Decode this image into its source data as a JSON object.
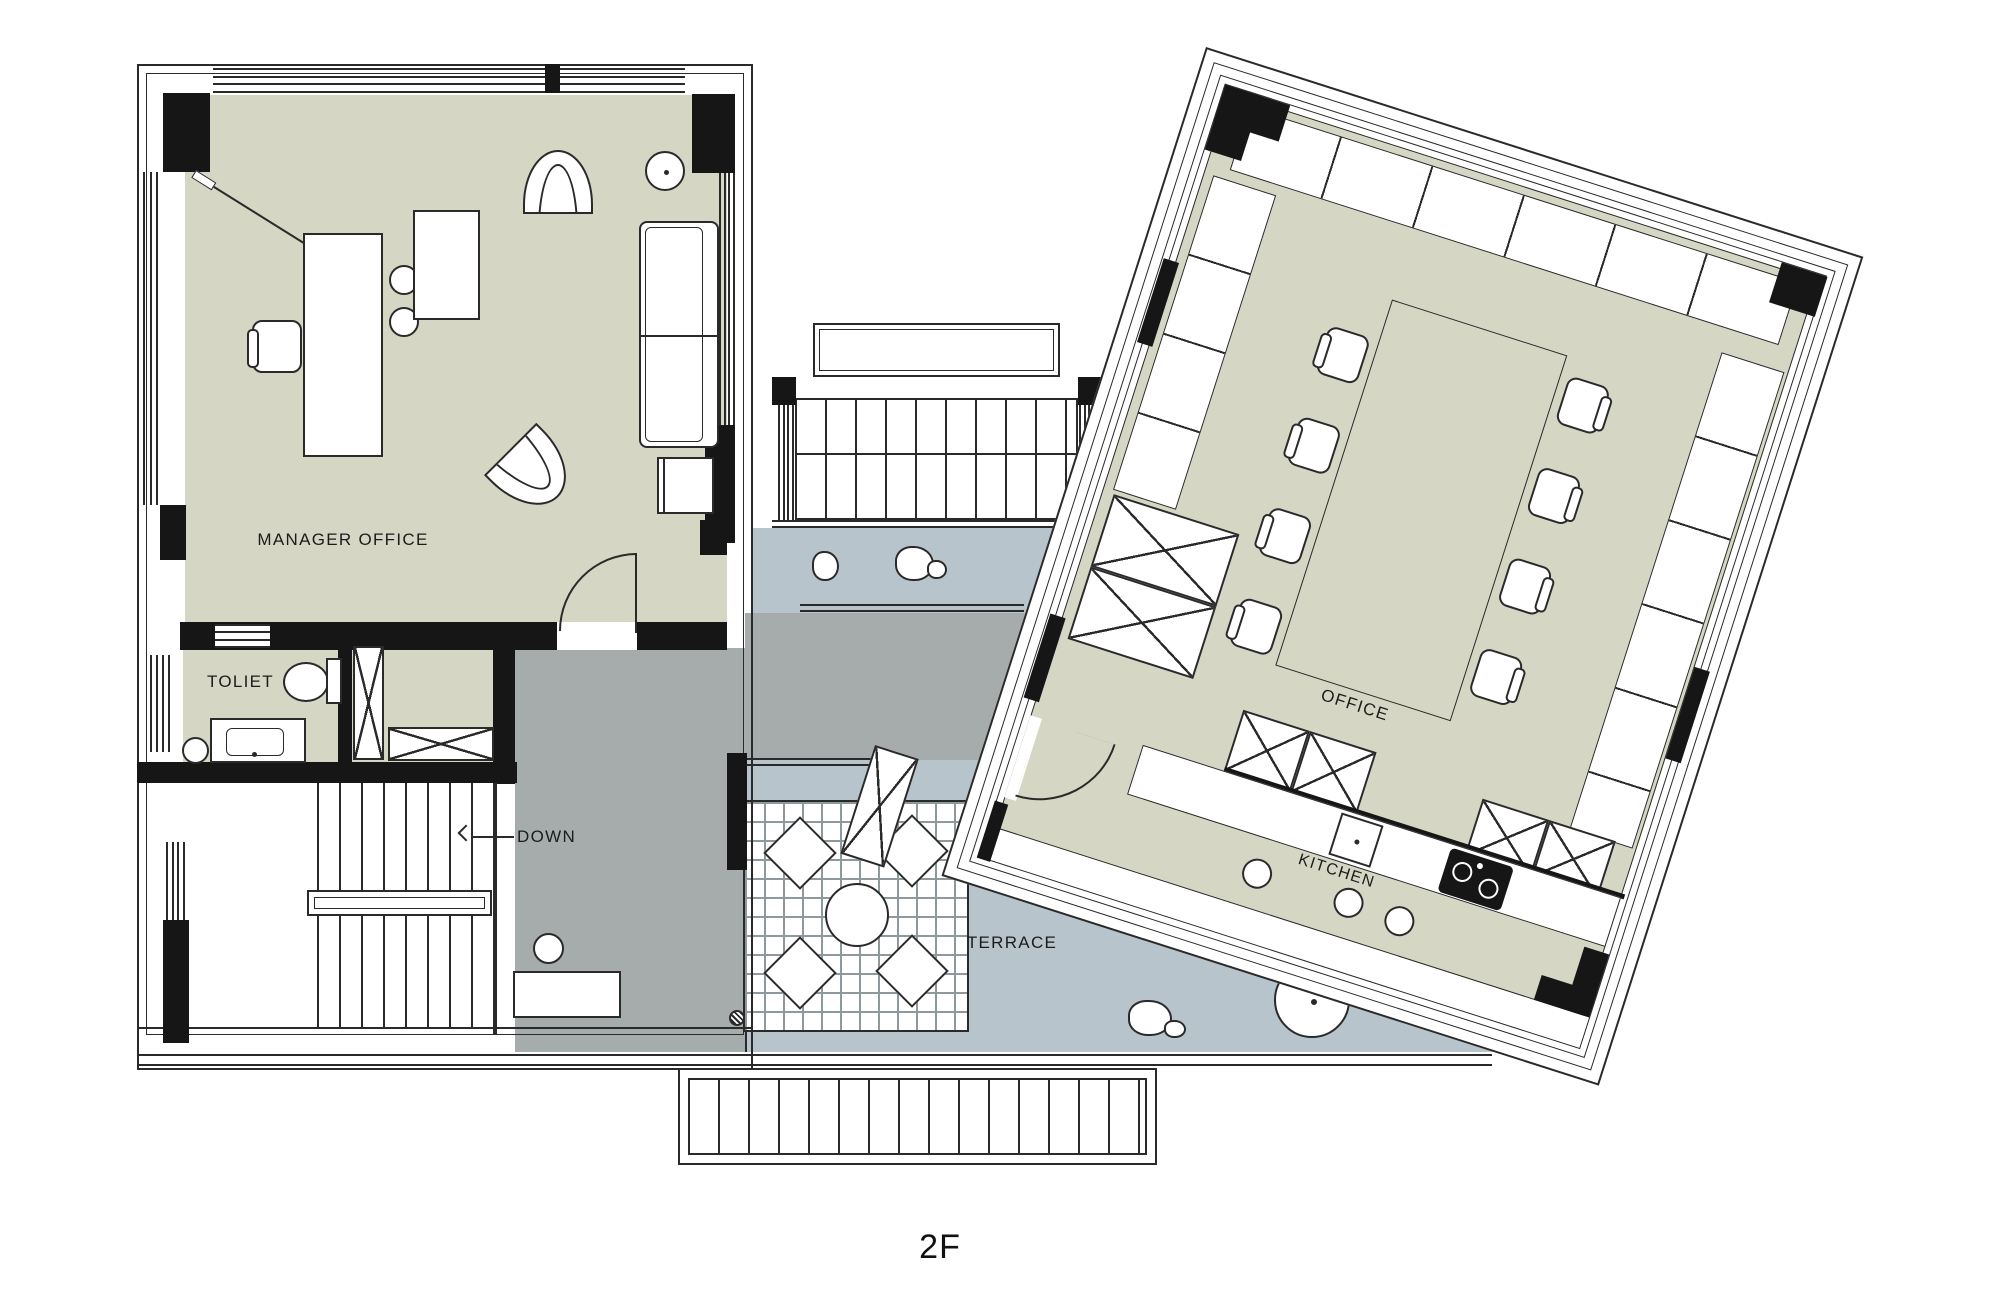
{
  "title": "2F",
  "rooms": {
    "manager_office": "MANAGER OFFICE",
    "toilet": "TOLIET",
    "stairs_down": "DOWN",
    "terrace": "TERRACE",
    "office": "OFFICE",
    "kitchen": "KITCHEN"
  },
  "colors": {
    "room_fill": "#d5d6c4",
    "terrace_fill": "#b7c4cb",
    "corridor_fill": "#a6acab",
    "wall": "#161616",
    "line": "#2a2a2a",
    "background": "#ffffff"
  }
}
